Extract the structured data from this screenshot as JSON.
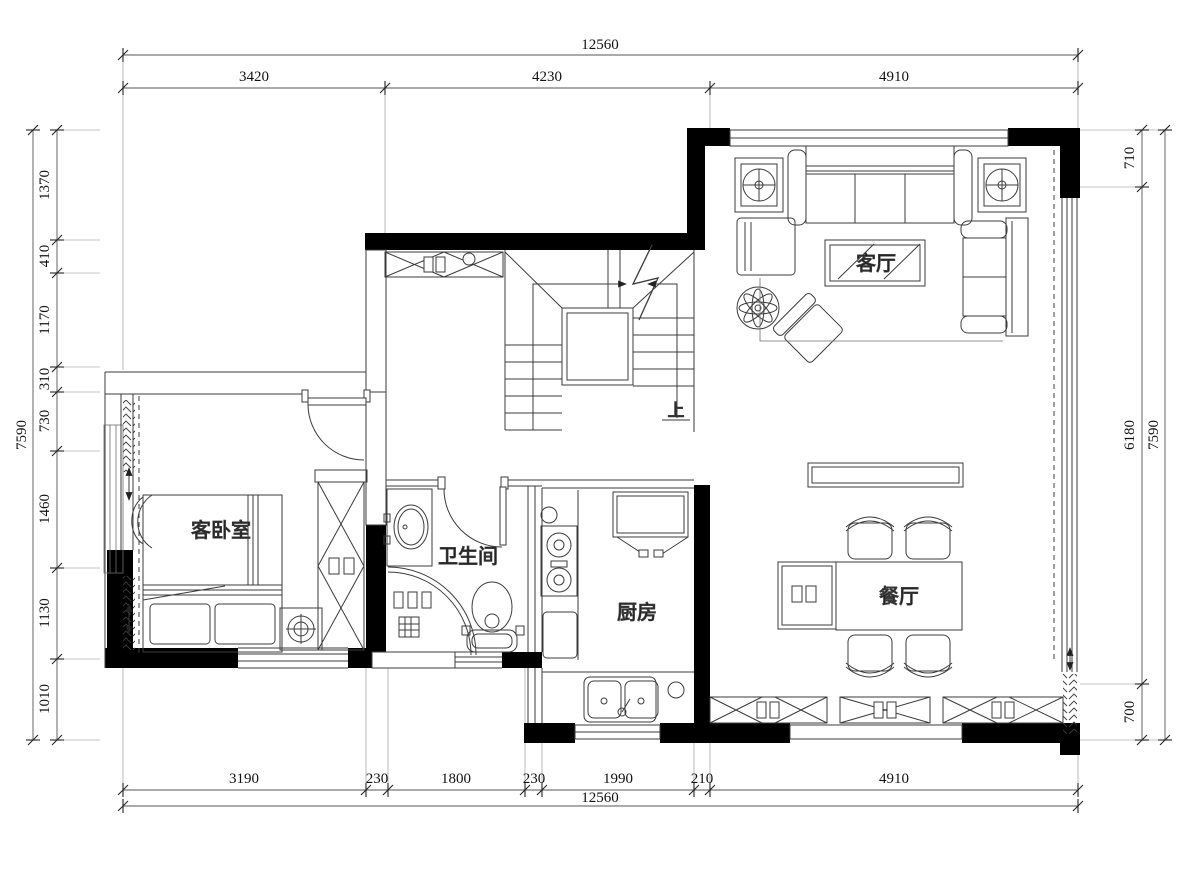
{
  "dims": {
    "top": {
      "total": "12560",
      "segments": [
        "3420",
        "4230",
        "4910"
      ]
    },
    "bottom": {
      "total": "12560",
      "segments": [
        "3190",
        "230",
        "1800",
        "230",
        "1990",
        "210",
        "4910"
      ]
    },
    "left": {
      "total": "7590",
      "segments": [
        "1370",
        "410",
        "1170",
        "310",
        "730",
        "1460",
        "1130",
        "1010"
      ]
    },
    "right": {
      "total": "7590",
      "segments": [
        "710",
        "6180",
        "700"
      ]
    }
  },
  "rooms": {
    "living": "客厅",
    "guest_bedroom": "客卧室",
    "bathroom": "卫生间",
    "kitchen": "厨房",
    "dining": "餐厅",
    "stair_up": "上"
  },
  "colors": {
    "wall": "#000000",
    "line": "#3b3b3b",
    "dimension": "#555555",
    "background": "#ffffff"
  }
}
